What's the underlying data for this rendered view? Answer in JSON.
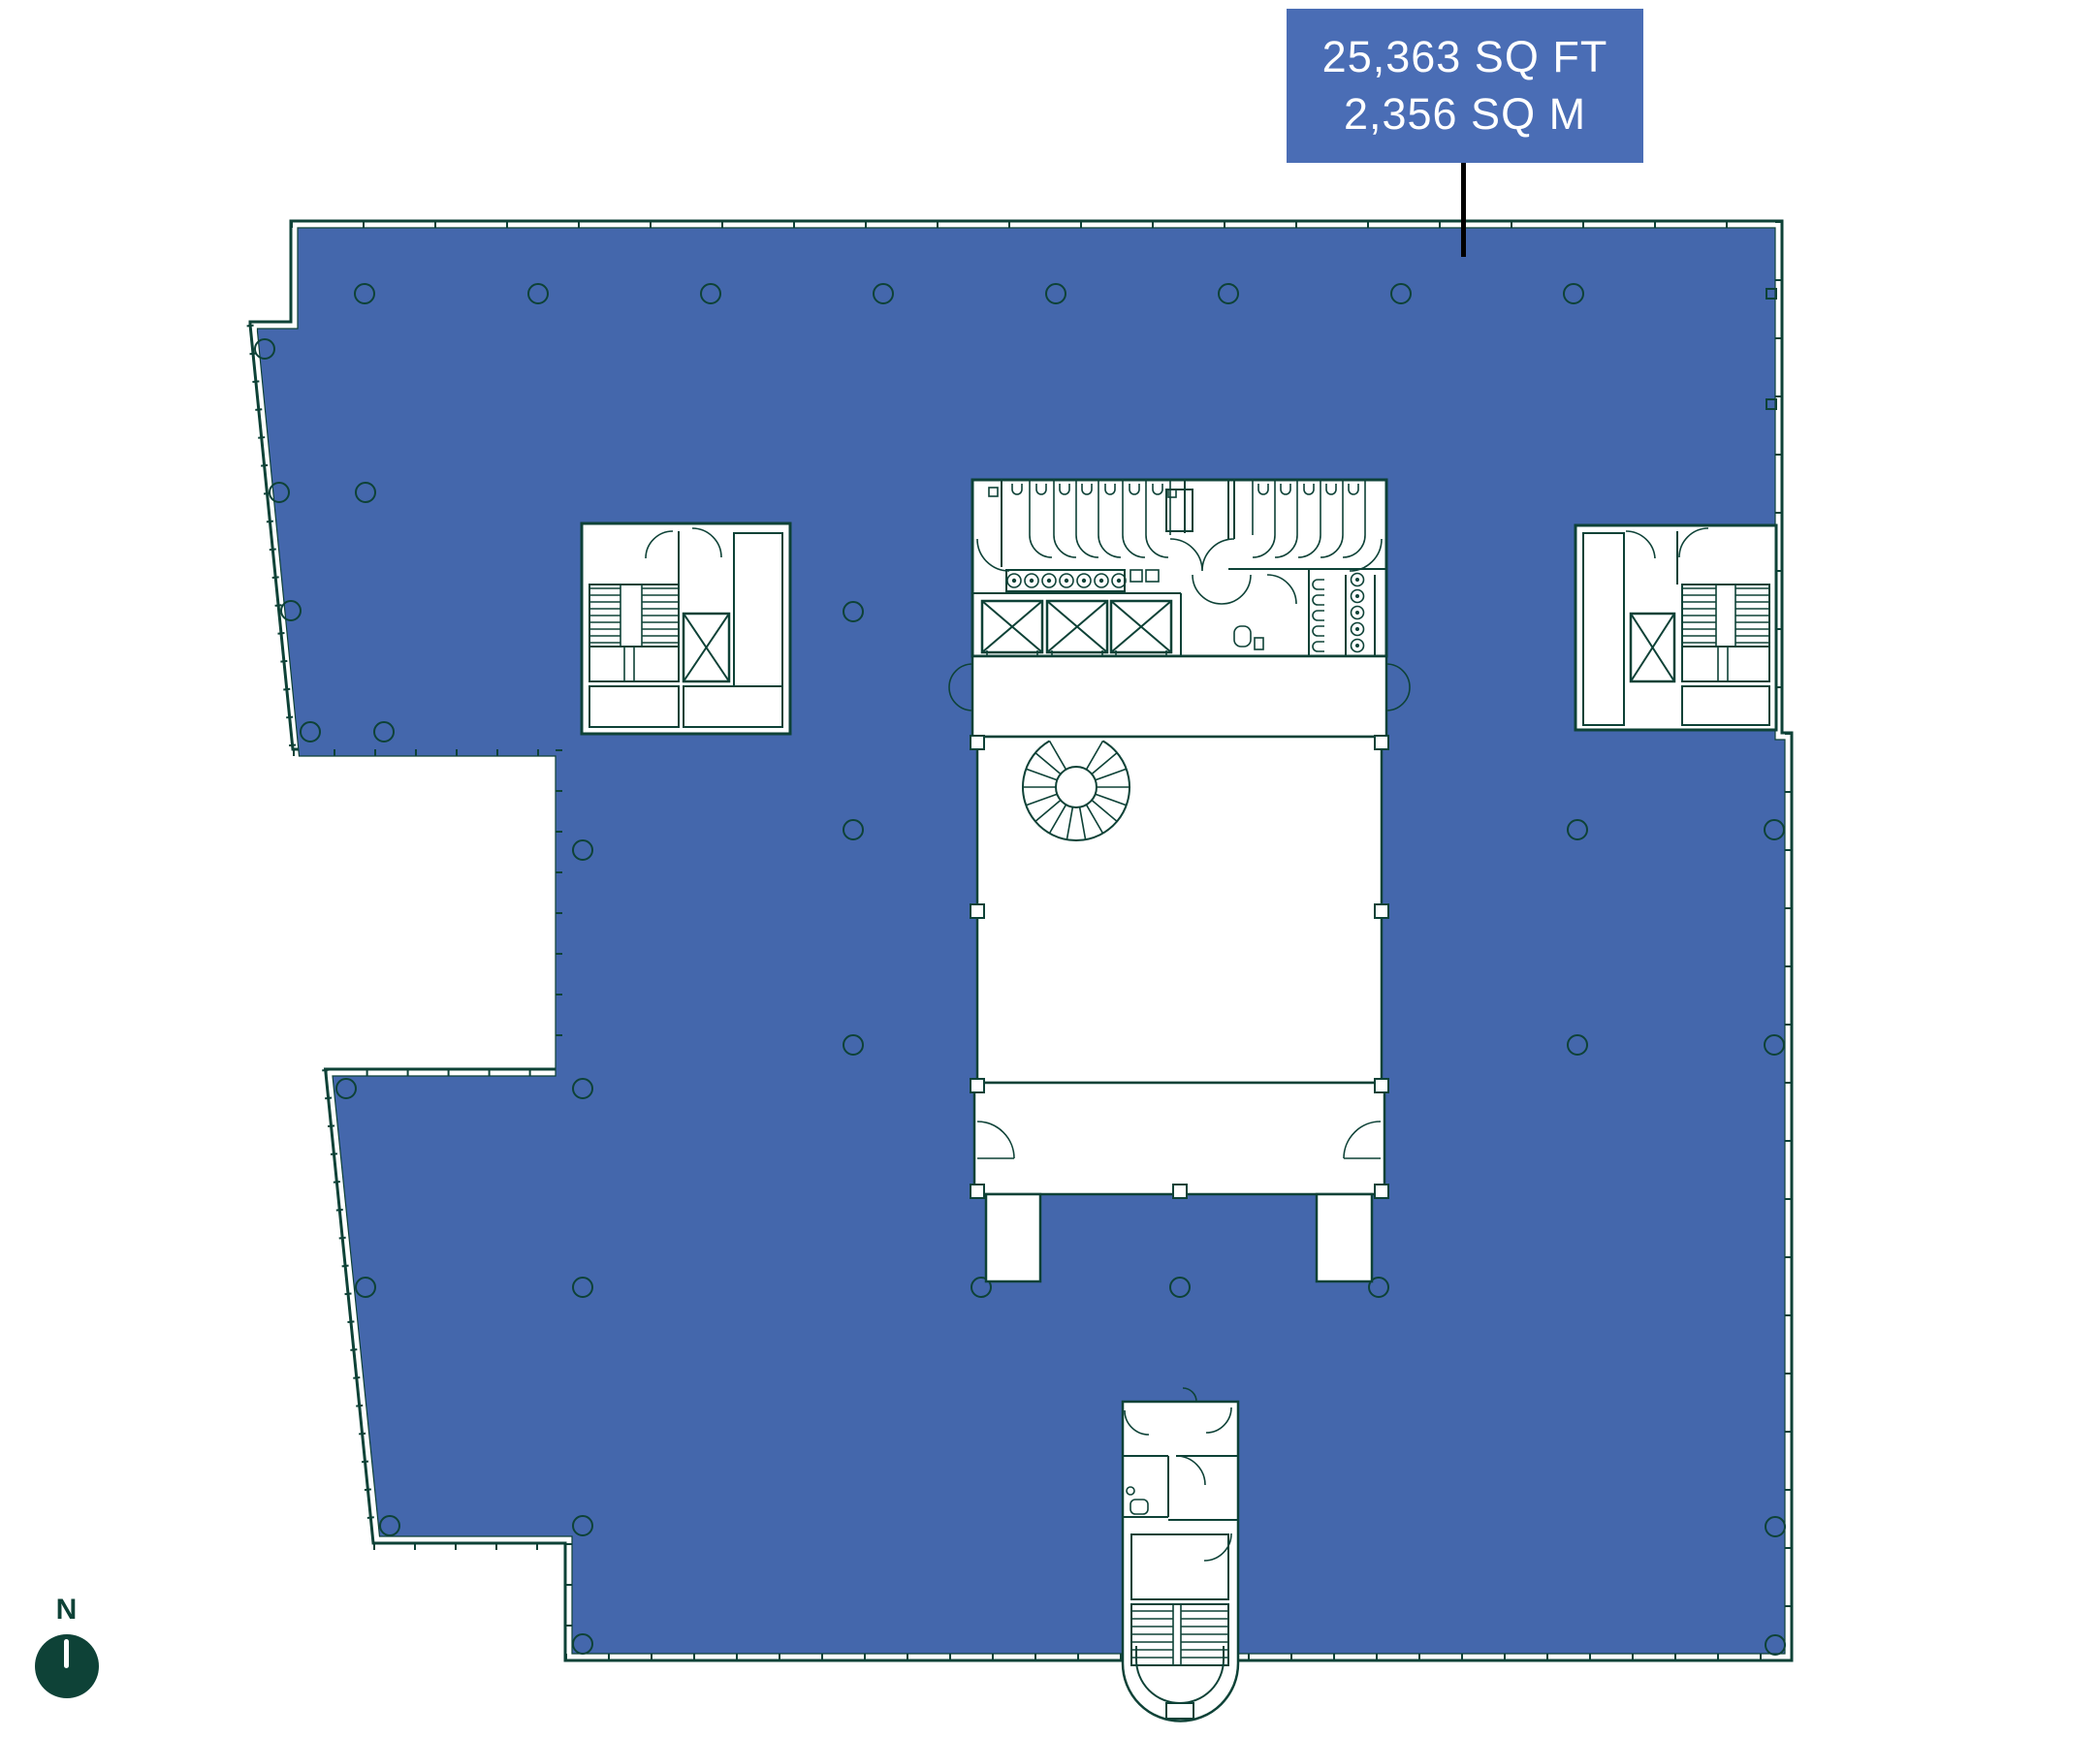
{
  "colors": {
    "line-green": "#0e4237",
    "floor-blue": "#4467ac",
    "label-blue": "#4a6db5",
    "leader-black": "#000000",
    "page-bg": "#ffffff"
  },
  "area_label": {
    "line1": "25,363 SQ FT",
    "line2": "2,356 SQ M"
  },
  "north_indicator": {
    "label": "N"
  }
}
